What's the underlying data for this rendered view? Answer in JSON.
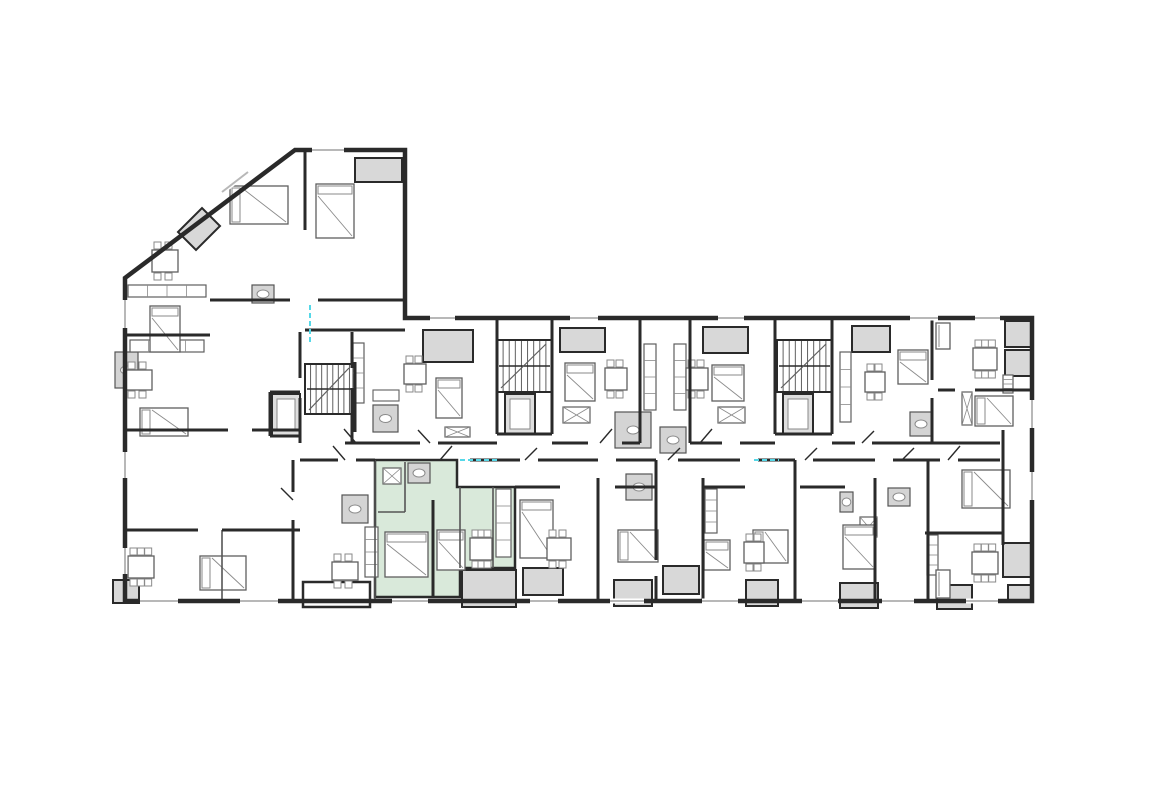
{
  "meta": {
    "canvas": {
      "w": 1173,
      "h": 786
    },
    "colors": {
      "background": "#ffffff",
      "wall": "#2a2a2a",
      "wall_light": "#555555",
      "balcony_fill": "#d8d8d8",
      "bath_fill": "#d4d4d4",
      "highlight_fill": "#d9e9da",
      "furniture": "#8a8a8a",
      "furniture_dark": "#5f5f5f",
      "window": "#b8b8b8",
      "accent_cyan": "#55d8e8"
    }
  },
  "plan": {
    "outline": [
      [
        295,
        150
      ],
      [
        405,
        150
      ],
      [
        405,
        318
      ],
      [
        1032,
        318
      ],
      [
        1032,
        601
      ],
      [
        125,
        601
      ],
      [
        125,
        278
      ]
    ],
    "highlight_unit": {
      "polygon": [
        [
          375,
          460
        ],
        [
          457,
          460
        ],
        [
          457,
          487
        ],
        [
          515,
          487
        ],
        [
          515,
          568
        ],
        [
          460,
          568
        ],
        [
          460,
          597
        ],
        [
          375,
          597
        ]
      ]
    },
    "diag_balcony": [
      [
        178,
        232
      ],
      [
        202,
        208
      ],
      [
        220,
        226
      ],
      [
        196,
        250
      ]
    ],
    "balconies": [
      [
        423,
        330,
        50,
        32
      ],
      [
        560,
        328,
        45,
        24
      ],
      [
        703,
        327,
        45,
        26
      ],
      [
        852,
        326,
        38,
        26
      ],
      [
        1005,
        321,
        26,
        26
      ],
      [
        1005,
        350,
        26,
        26
      ],
      [
        1003,
        543,
        28,
        34
      ],
      [
        1008,
        585,
        24,
        17
      ],
      [
        113,
        580,
        26,
        23
      ],
      [
        462,
        570,
        54,
        37
      ],
      [
        523,
        568,
        40,
        27
      ],
      [
        614,
        580,
        38,
        26
      ],
      [
        663,
        566,
        36,
        28
      ],
      [
        746,
        580,
        32,
        26
      ],
      [
        840,
        583,
        38,
        25
      ],
      [
        937,
        585,
        35,
        24
      ],
      [
        355,
        158,
        47,
        24
      ]
    ],
    "porches": [
      [
        303,
        582,
        67,
        25
      ]
    ],
    "walls": [
      [
        305,
        152,
        305,
        230
      ],
      [
        210,
        300,
        290,
        300
      ],
      [
        318,
        300,
        405,
        300
      ],
      [
        125,
        335,
        210,
        335
      ],
      [
        300,
        332,
        300,
        378
      ],
      [
        300,
        398,
        300,
        443
      ],
      [
        352,
        332,
        352,
        368
      ],
      [
        352,
        388,
        352,
        443
      ],
      [
        125,
        430,
        228,
        430
      ],
      [
        252,
        430,
        300,
        430
      ],
      [
        125,
        530,
        198,
        530
      ],
      [
        222,
        530,
        300,
        530
      ],
      [
        293,
        460,
        293,
        492
      ],
      [
        293,
        520,
        293,
        601
      ],
      [
        305,
        330,
        405,
        330
      ],
      [
        355,
        362,
        355,
        432
      ],
      [
        270,
        392,
        300,
        392
      ],
      [
        270,
        436,
        300,
        436
      ],
      [
        270,
        392,
        270,
        436
      ],
      [
        497,
        318,
        497,
        434
      ],
      [
        552,
        318,
        552,
        434
      ],
      [
        497,
        434,
        552,
        434
      ],
      [
        640,
        318,
        640,
        443
      ],
      [
        690,
        318,
        690,
        443
      ],
      [
        775,
        318,
        775,
        434
      ],
      [
        832,
        318,
        832,
        434
      ],
      [
        775,
        434,
        832,
        434
      ],
      [
        932,
        318,
        932,
        380
      ],
      [
        932,
        398,
        932,
        443
      ],
      [
        938,
        390,
        955,
        390
      ],
      [
        975,
        390,
        1032,
        390
      ],
      [
        345,
        443,
        420,
        443
      ],
      [
        438,
        443,
        497,
        443
      ],
      [
        552,
        443,
        588,
        443
      ],
      [
        622,
        443,
        640,
        443
      ],
      [
        690,
        443,
        722,
        443
      ],
      [
        740,
        443,
        775,
        443
      ],
      [
        832,
        443,
        855,
        443
      ],
      [
        872,
        443,
        1000,
        443
      ],
      [
        300,
        460,
        338,
        460
      ],
      [
        356,
        460,
        375,
        460
      ],
      [
        470,
        460,
        520,
        460
      ],
      [
        538,
        460,
        598,
        460
      ],
      [
        616,
        460,
        656,
        460
      ],
      [
        678,
        460,
        740,
        460
      ],
      [
        758,
        460,
        795,
        460
      ],
      [
        813,
        460,
        875,
        460
      ],
      [
        893,
        460,
        940,
        460
      ],
      [
        958,
        460,
        1000,
        460
      ],
      [
        598,
        478,
        598,
        601
      ],
      [
        656,
        460,
        656,
        560
      ],
      [
        656,
        576,
        656,
        601
      ],
      [
        703,
        478,
        703,
        601
      ],
      [
        795,
        460,
        795,
        601
      ],
      [
        875,
        478,
        875,
        601
      ],
      [
        928,
        460,
        928,
        601
      ],
      [
        1003,
        430,
        1003,
        545
      ],
      [
        515,
        487,
        560,
        487
      ],
      [
        615,
        487,
        656,
        487
      ],
      [
        703,
        487,
        745,
        487
      ],
      [
        800,
        487,
        845,
        487
      ],
      [
        925,
        533,
        1003,
        533
      ],
      [
        433,
        500,
        433,
        597
      ]
    ],
    "thin_walls": [
      [
        405,
        462,
        405,
        512
      ],
      [
        378,
        512,
        405,
        512
      ],
      [
        460,
        487,
        460,
        568
      ],
      [
        493,
        487,
        493,
        568
      ],
      [
        375,
        460,
        375,
        601
      ],
      [
        222,
        530,
        222,
        601
      ]
    ],
    "windows": [
      [
        140,
        601,
        178,
        601
      ],
      [
        240,
        601,
        278,
        601
      ],
      [
        392,
        601,
        428,
        601
      ],
      [
        530,
        601,
        558,
        601
      ],
      [
        610,
        601,
        644,
        601
      ],
      [
        702,
        601,
        738,
        601
      ],
      [
        802,
        601,
        838,
        601
      ],
      [
        882,
        601,
        914,
        601
      ],
      [
        966,
        601,
        998,
        601
      ],
      [
        125,
        300,
        125,
        328
      ],
      [
        125,
        452,
        125,
        478
      ],
      [
        125,
        548,
        125,
        574
      ],
      [
        312,
        150,
        344,
        150
      ],
      [
        222,
        192,
        248,
        172
      ],
      [
        1032,
        400,
        1032,
        428
      ],
      [
        1032,
        472,
        1032,
        500
      ],
      [
        430,
        318,
        455,
        318
      ],
      [
        570,
        318,
        598,
        318
      ],
      [
        718,
        318,
        744,
        318
      ],
      [
        910,
        318,
        938,
        318
      ],
      [
        975,
        318,
        1000,
        318
      ]
    ],
    "stairs": [
      {
        "x": 305,
        "y": 364,
        "w": 50,
        "h": 50
      },
      {
        "x": 497,
        "y": 340,
        "w": 55,
        "h": 52
      },
      {
        "x": 777,
        "y": 340,
        "w": 55,
        "h": 52
      }
    ],
    "elevators": [
      [
        272,
        394,
        28,
        42
      ],
      [
        505,
        394,
        30,
        40
      ],
      [
        783,
        394,
        30,
        40
      ]
    ],
    "bathrooms": [
      [
        115,
        352,
        23,
        36
      ],
      [
        252,
        285,
        22,
        18
      ],
      [
        342,
        495,
        26,
        28
      ],
      [
        373,
        405,
        25,
        27
      ],
      [
        408,
        463,
        22,
        20
      ],
      [
        615,
        412,
        36,
        36
      ],
      [
        660,
        427,
        26,
        26
      ],
      [
        626,
        474,
        26,
        26
      ],
      [
        840,
        492,
        13,
        20
      ],
      [
        888,
        488,
        22,
        18
      ],
      [
        910,
        412,
        22,
        24
      ]
    ],
    "kitchens": [
      [
        128,
        285,
        78,
        12
      ],
      [
        130,
        340,
        74,
        12
      ],
      [
        353,
        343,
        11,
        60
      ],
      [
        496,
        489,
        15,
        68
      ],
      [
        644,
        344,
        12,
        66
      ],
      [
        674,
        344,
        12,
        66
      ],
      [
        705,
        489,
        12,
        44
      ],
      [
        840,
        352,
        11,
        70
      ],
      [
        1003,
        375,
        10,
        18
      ],
      [
        927,
        535,
        11,
        40
      ],
      [
        365,
        527,
        13,
        50
      ]
    ],
    "wardrobes": [
      [
        383,
        468,
        18,
        16
      ],
      [
        445,
        427,
        25,
        10
      ],
      [
        563,
        407,
        27,
        16
      ],
      [
        718,
        407,
        27,
        16
      ],
      [
        962,
        392,
        10,
        33
      ],
      [
        860,
        517,
        17,
        20
      ]
    ],
    "beds": [
      [
        230,
        186,
        58,
        38
      ],
      [
        316,
        184,
        38,
        54
      ],
      [
        150,
        306,
        30,
        46
      ],
      [
        140,
        408,
        48,
        28
      ],
      [
        200,
        556,
        46,
        34
      ],
      [
        436,
        378,
        26,
        40
      ],
      [
        565,
        363,
        30,
        38
      ],
      [
        712,
        365,
        32,
        36
      ],
      [
        898,
        350,
        30,
        34
      ],
      [
        975,
        396,
        38,
        30
      ],
      [
        385,
        532,
        43,
        45
      ],
      [
        437,
        530,
        28,
        40
      ],
      [
        520,
        500,
        33,
        58
      ],
      [
        618,
        530,
        40,
        32
      ],
      [
        704,
        540,
        26,
        30
      ],
      [
        753,
        530,
        35,
        33
      ],
      [
        843,
        525,
        32,
        44
      ],
      [
        962,
        470,
        48,
        38
      ]
    ],
    "tables": [
      [
        152,
        250,
        26,
        22,
        4
      ],
      [
        126,
        370,
        26,
        20,
        4
      ],
      [
        128,
        556,
        26,
        22,
        6
      ],
      [
        332,
        562,
        26,
        18,
        4
      ],
      [
        404,
        364,
        22,
        20,
        4
      ],
      [
        470,
        538,
        22,
        22,
        6
      ],
      [
        605,
        368,
        22,
        22,
        4
      ],
      [
        686,
        368,
        22,
        22,
        4
      ],
      [
        865,
        372,
        20,
        20,
        4
      ],
      [
        973,
        348,
        24,
        22,
        6
      ],
      [
        972,
        552,
        26,
        22,
        6
      ],
      [
        744,
        542,
        20,
        21,
        4
      ],
      [
        547,
        538,
        24,
        22,
        4
      ]
    ],
    "sofas": [
      [
        936,
        323,
        14,
        26
      ],
      [
        936,
        570,
        14,
        28
      ]
    ],
    "desks": [
      [
        373,
        390,
        26,
        11
      ]
    ],
    "doors": [
      [
        430,
        443,
        418,
        430
      ],
      [
        525,
        460,
        537,
        448
      ],
      [
        600,
        443,
        612,
        429
      ],
      [
        668,
        460,
        680,
        448
      ],
      [
        700,
        443,
        712,
        429
      ],
      [
        805,
        460,
        817,
        448
      ],
      [
        862,
        443,
        874,
        431
      ],
      [
        902,
        460,
        914,
        448
      ],
      [
        948,
        460,
        960,
        446
      ],
      [
        345,
        460,
        333,
        446
      ],
      [
        440,
        460,
        452,
        446
      ],
      [
        356,
        443,
        344,
        429
      ],
      [
        293,
        500,
        281,
        488
      ]
    ],
    "cyan_lines": [
      [
        310,
        305,
        310,
        342
      ],
      [
        460,
        460,
        498,
        460
      ],
      [
        754,
        460,
        779,
        460
      ]
    ]
  }
}
